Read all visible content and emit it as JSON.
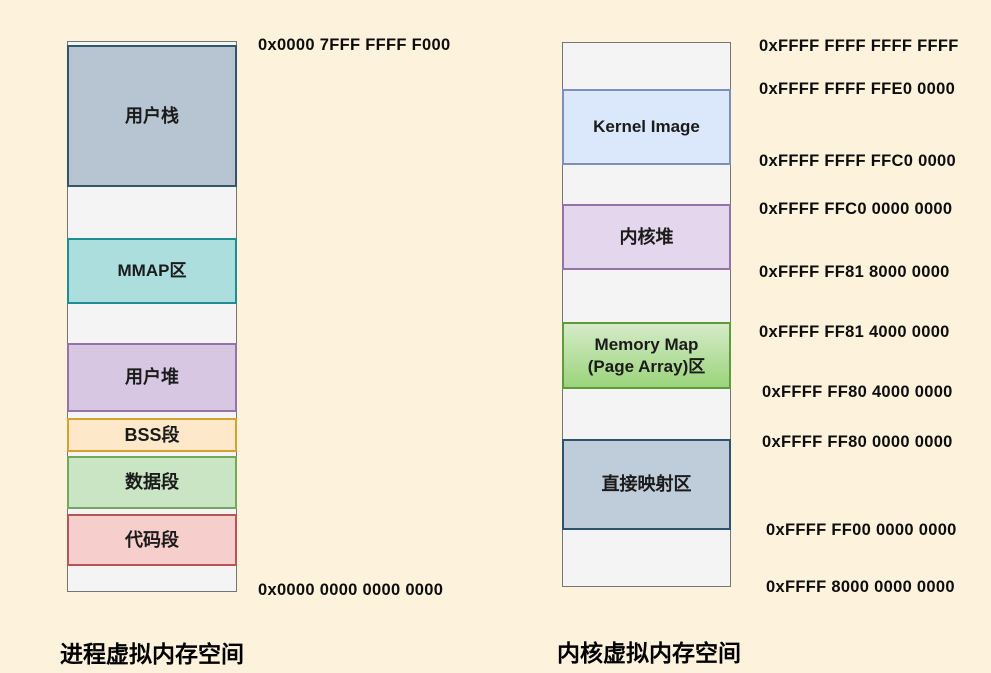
{
  "page": {
    "background": "#fdf3dd"
  },
  "process_space": {
    "caption": "进程虚拟内存空间",
    "top_address": "0x0000 7FFF FFFF F000",
    "bottom_address": "0x0000 0000 0000 0000",
    "blocks": [
      {
        "label": "用户栈",
        "fill": "#b6c5d1",
        "border": "#33566b"
      },
      {
        "label": "MMAP区",
        "fill": "#abdedd",
        "border": "#1d8f94"
      },
      {
        "label": "用户堆",
        "fill": "#d8c7e2",
        "border": "#9673a6"
      },
      {
        "label": "BSS段",
        "fill": "#fde9c9",
        "border": "#d7a02f"
      },
      {
        "label": "数据段",
        "fill": "#c9e5c4",
        "border": "#74a75c"
      },
      {
        "label": "代码段",
        "fill": "#f6cecb",
        "border": "#b85450"
      }
    ]
  },
  "kernel_space": {
    "caption": "内核虚拟内存空间",
    "blocks": [
      {
        "label": "Kernel Image",
        "fill": "#dbe8fb",
        "border": "#7b8fc0"
      },
      {
        "label": "内核堆",
        "fill": "#e4d6ec",
        "border": "#9673a6"
      },
      {
        "label": "Memory Map\n(Page Array)区",
        "fill": "#d5ebc8",
        "fill2": "#9bd47b",
        "border": "#61993f"
      },
      {
        "label": "直接映射区",
        "fill": "#bfccd9",
        "border": "#2d536e"
      }
    ],
    "addresses": [
      "0xFFFF FFFF FFFF FFFF",
      "0xFFFF FFFF FFE0 0000",
      "0xFFFF FFFF FFC0 0000",
      "0xFFFF FFC0 0000 0000",
      "0xFFFF FF81 8000 0000",
      "0xFFFF FF81 4000 0000",
      "0xFFFF FF80 4000 0000",
      "0xFFFF FF80 0000 0000",
      "0xFFFF FF00 0000 0000",
      "0xFFFF 8000 0000 0000"
    ]
  }
}
